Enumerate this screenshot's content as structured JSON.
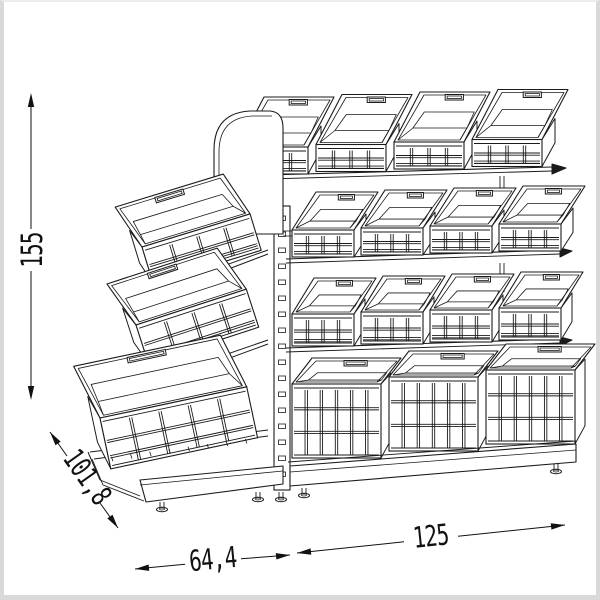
{
  "page": {
    "background": "#ffffff",
    "frame_color": "#d9d9d9"
  },
  "drawing": {
    "subject": "double-sided gondola shelving rack with stacking crates, technical dimension drawing",
    "line_color": "#1b1b1b",
    "dimensions": [
      {
        "id": "height",
        "label": "155",
        "orientation": "vertical"
      },
      {
        "id": "depth",
        "label": "101,8",
        "orientation": "diagonal"
      },
      {
        "id": "side-width",
        "label": "64,4",
        "orientation": "horizontal"
      },
      {
        "id": "front-width",
        "label": "125",
        "orientation": "horizontal"
      }
    ],
    "shelf_rows_right": [
      {
        "bins": 4
      },
      {
        "bins": 4
      },
      {
        "bins": 4
      },
      {
        "bins": 3
      }
    ],
    "tilted_bins_left": 3
  }
}
